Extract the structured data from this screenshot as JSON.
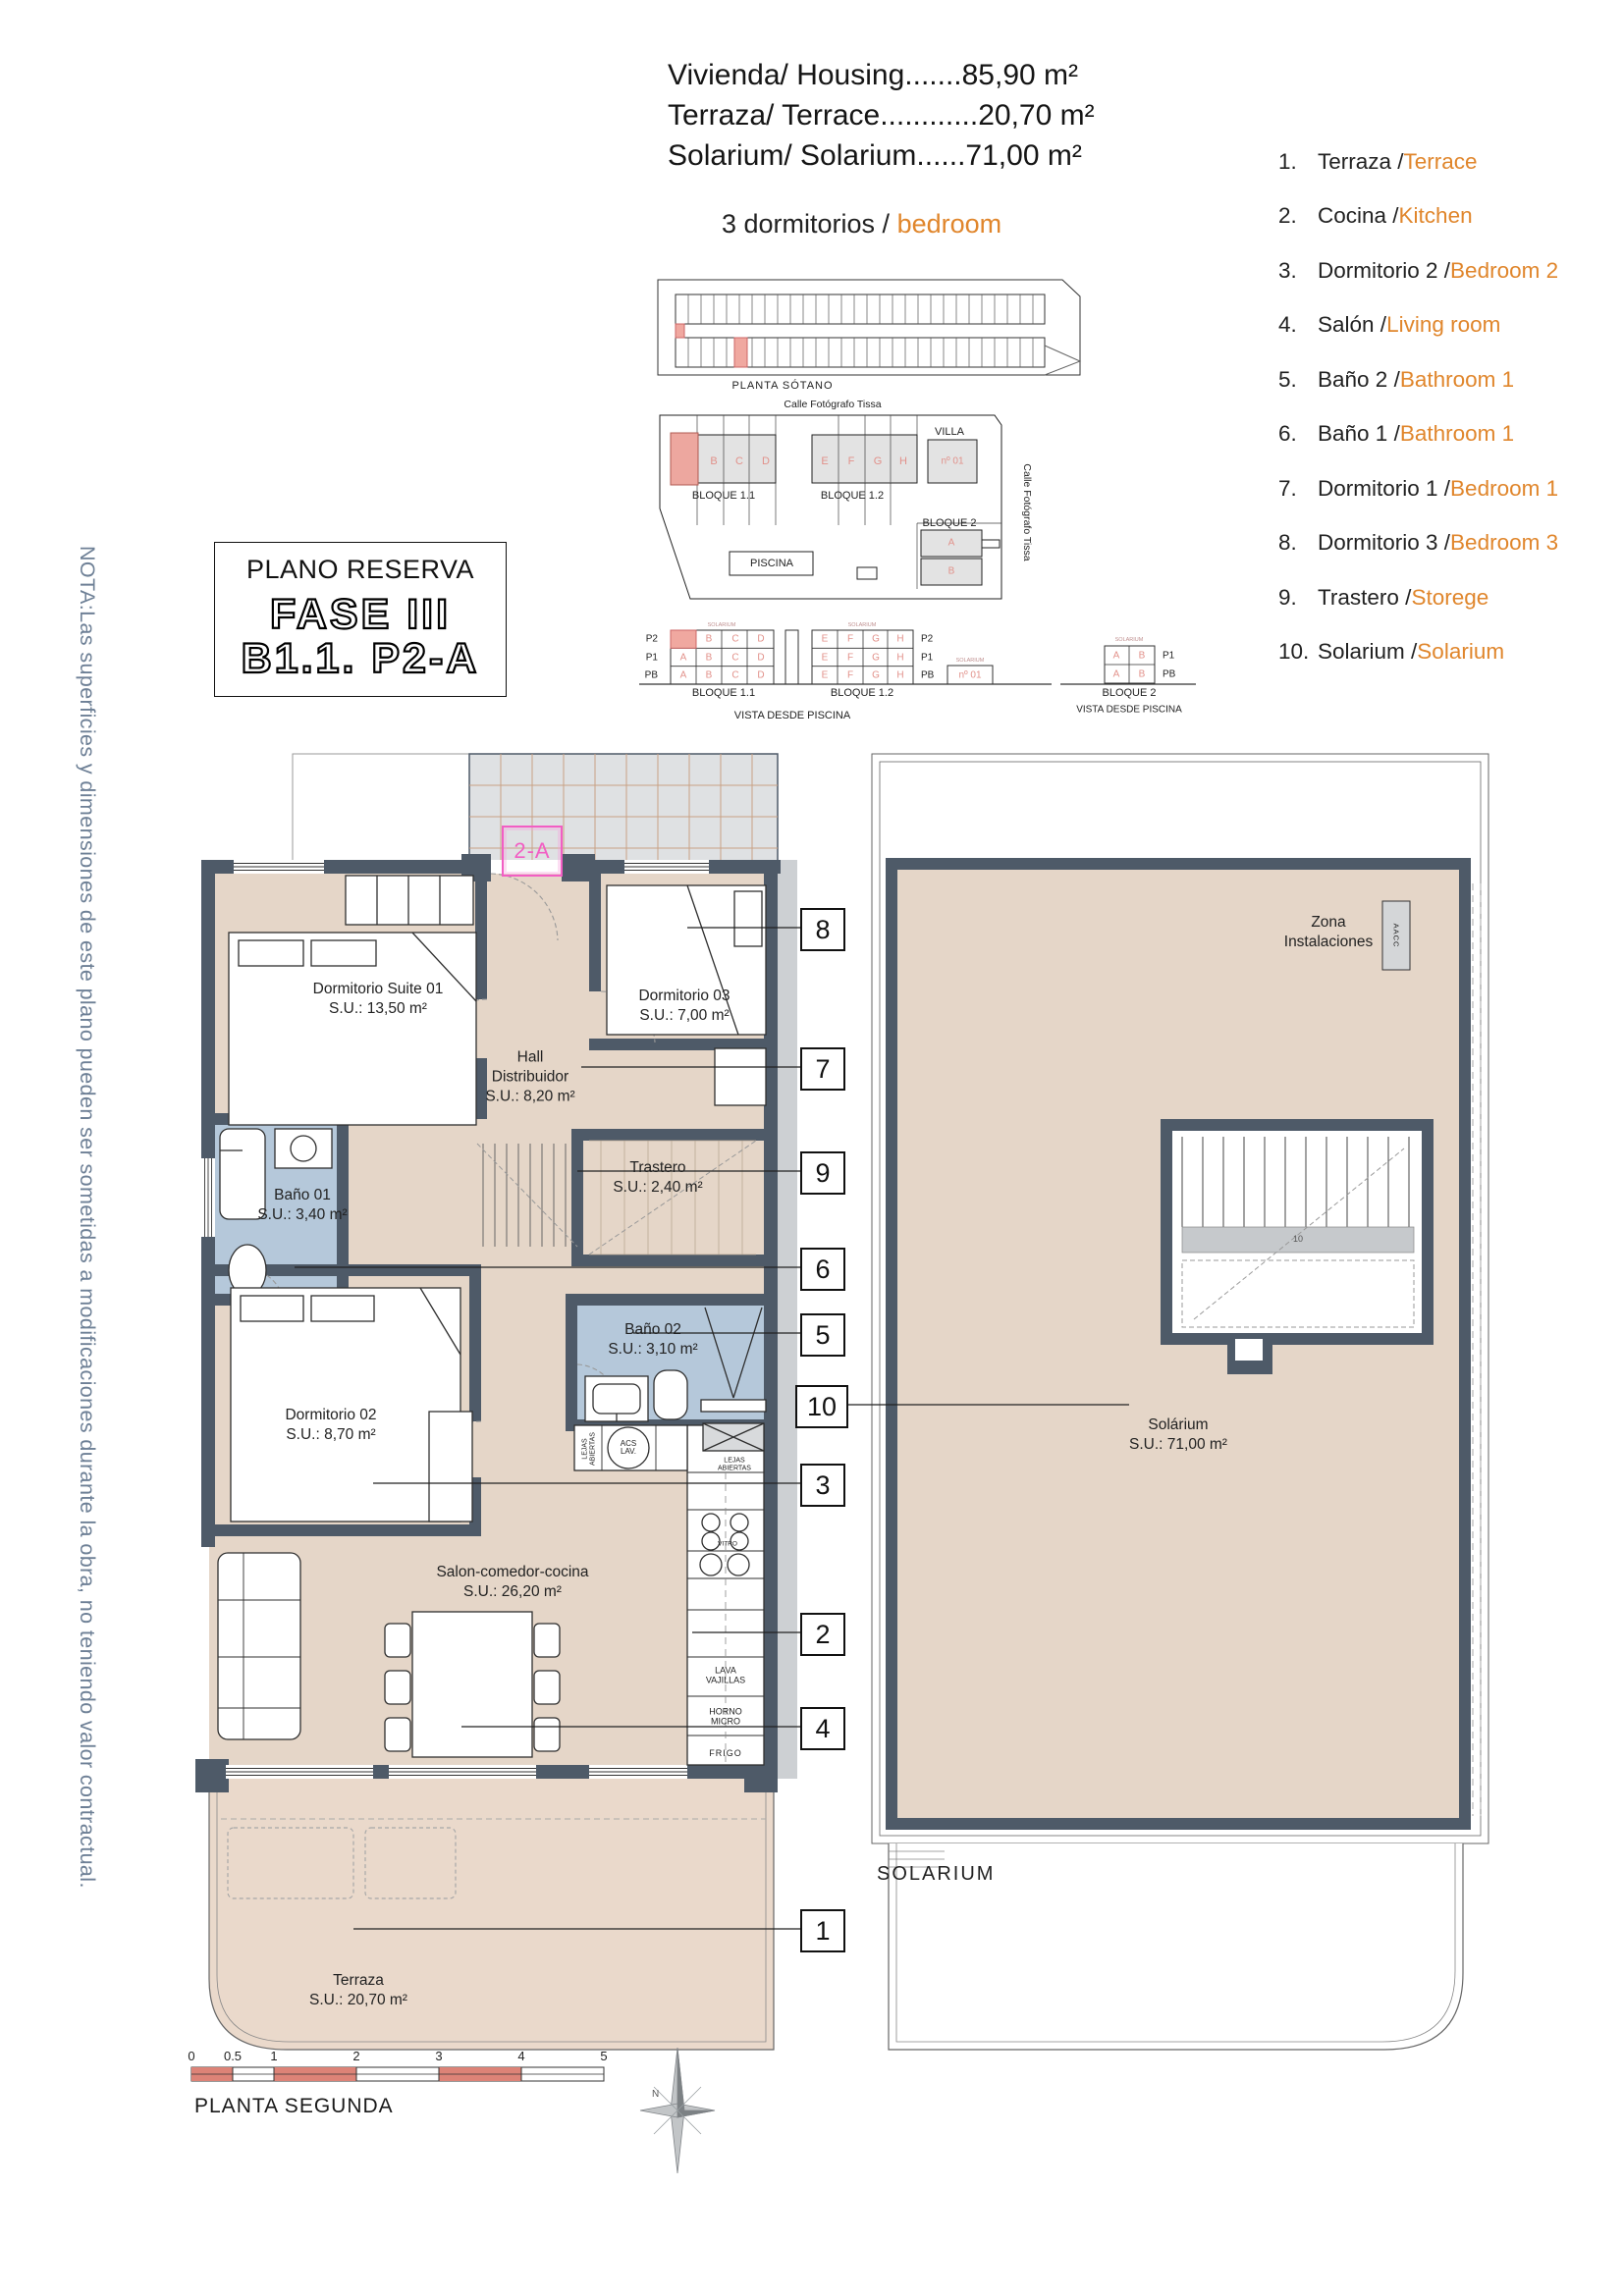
{
  "note": "NOTA:Las superficies y dimensiones de este plano pueden ser sometidas a modificaciones durante la obra, no teniendo valor contractual.",
  "summary": {
    "line1": "Vivienda/ Housing.......85,90 m²",
    "line2": "Terraza/ Terrace............20,70 m²",
    "line3": "Solarium/ Solarium......71,00 m²",
    "subtitle_es": "3 dormitorios / ",
    "subtitle_en": "bedroom"
  },
  "legend": {
    "items": [
      {
        "num": "1.",
        "es": "Terraza / ",
        "en": "Terrace"
      },
      {
        "num": "2.",
        "es": "Cocina / ",
        "en": "Kitchen"
      },
      {
        "num": "3.",
        "es": "Dormitorio 2 / ",
        "en": "Bedroom 2"
      },
      {
        "num": "4.",
        "es": "Salón / ",
        "en": "Living room"
      },
      {
        "num": "5.",
        "es": "Baño 2 / ",
        "en": "Bathroom 1"
      },
      {
        "num": "6.",
        "es": "Baño 1 / ",
        "en": "Bathroom 1"
      },
      {
        "num": "7.",
        "es": "Dormitorio 1 / ",
        "en": "Bedroom 1"
      },
      {
        "num": "8.",
        "es": "Dormitorio 3 / ",
        "en": "Bedroom 3"
      },
      {
        "num": "9.",
        "es": "Trastero / ",
        "en": "Storege"
      },
      {
        "num": "10.",
        "es": "Solarium / ",
        "en": "Solarium"
      }
    ]
  },
  "title_block": {
    "title": "PLANO RESERVA",
    "fase": "FASE III",
    "unit": "B1.1. P2-A"
  },
  "site": {
    "sotano_label": "PLANTA SÓTANO",
    "street_top": "Calle Fotógrafo Tissa",
    "street_right": "Calle Fotógrafo Tissa",
    "bloque11": "BLOQUE 1.1",
    "bloque12": "BLOQUE 1.2",
    "bloque2": "BLOQUE 2",
    "villa": "VILLA",
    "villa_num": "nº 01",
    "piscina": "PISCINA",
    "letters": [
      "A",
      "B",
      "C",
      "D",
      "E",
      "F",
      "G",
      "H"
    ],
    "floors": [
      "P2",
      "P1",
      "PB"
    ],
    "vista": "VISTA DESDE PISCINA",
    "solarium_tiny": "SOLARIUM"
  },
  "plan": {
    "unit_tag": "2-A",
    "rooms": {
      "suite_name": "Dormitorio Suite 01",
      "suite_area": "S.U.: 13,50 m²",
      "d3_name": "Dormitorio 03",
      "d3_area": "S.U.: 7,00 m²",
      "hall_1": "Hall",
      "hall_2": "Distribuidor",
      "hall_area": "S.U.: 8,20 m²",
      "tras_name": "Trastero",
      "tras_area": "S.U.: 2,40 m²",
      "b1_name": "Baño 01",
      "b1_area": "S.U.: 3,40 m²",
      "b2_name": "Baño 02",
      "b2_area": "S.U.: 3,10 m²",
      "d2_name": "Dormitorio 02",
      "d2_area": "S.U.: 8,70 m²",
      "salon_name": "Salon-comedor-cocina",
      "salon_area": "S.U.: 26,20 m²",
      "terraza_name": "Terraza",
      "terraza_area": "S.U.: 20,70 m²",
      "sol_name": "Solárium",
      "sol_area": "S.U.: 71,00 m²",
      "zona_1": "Zona",
      "zona_2": "Instalaciones"
    },
    "fixtures": {
      "lejas": "LEJAS ABIERTAS",
      "acs": "ACS LAV.",
      "vitro": "VITRO",
      "lava": "LAVA VAJILLAS",
      "horno": "HORNO MICRO",
      "frigo": "FRIGO",
      "aacc": "AACC"
    },
    "callouts": [
      "8",
      "7",
      "9",
      "6",
      "5",
      "10",
      "3",
      "2",
      "4",
      "1"
    ],
    "stair_num": "10",
    "section_label": "SOLARIUM"
  },
  "footer": {
    "ticks": [
      "0",
      "0.5",
      "1",
      "2",
      "3",
      "4",
      "5"
    ],
    "label": "PLANTA SEGUNDA",
    "north": "N"
  },
  "colors": {
    "accent_orange": "#e0862c",
    "wall": "#4e5a68",
    "floor": "#e5d6c8",
    "bath": "#b5c8da",
    "highlight_pink": "#f0a8a0",
    "tag_pink": "#f25ec4",
    "scale_red": "#dd8377"
  }
}
